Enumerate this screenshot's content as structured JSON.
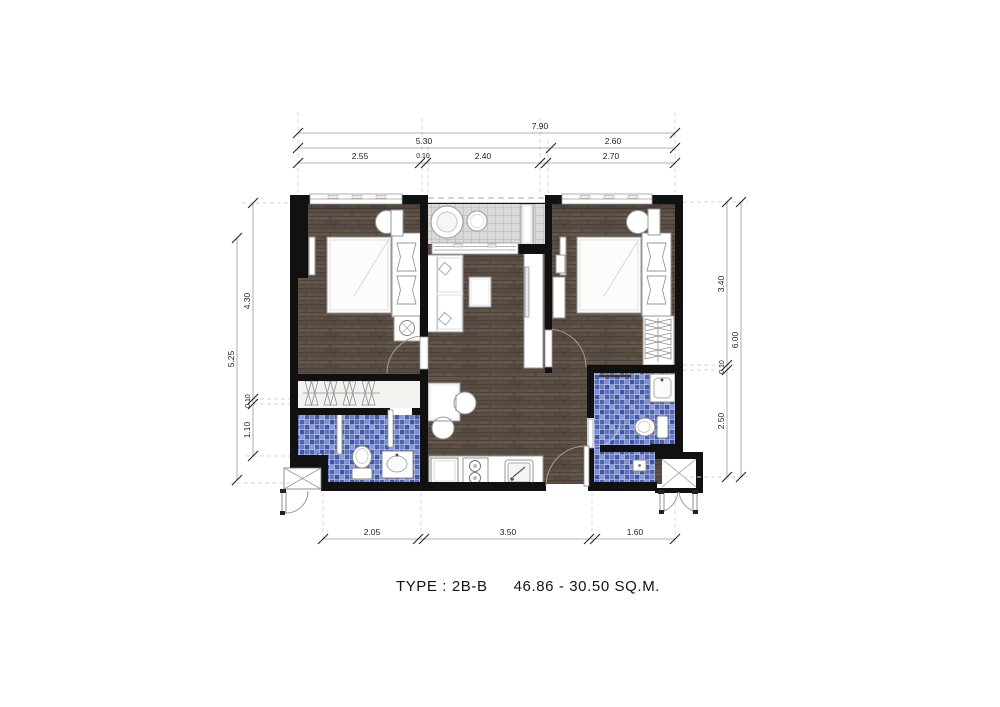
{
  "title": {
    "type": "TYPE : 2B-B",
    "area": "46.86 - 30.50 SQ.M."
  },
  "dims": {
    "top_total": "7.90",
    "top_mid": [
      "5.30",
      "2.60"
    ],
    "top_inner": [
      "2.55",
      "0.10",
      "2.40",
      "2.70"
    ],
    "left_outer": "5.25",
    "left_inner": [
      "4.30",
      "0.10",
      "1.10"
    ],
    "right_inner": [
      "3.40",
      "0.10",
      "2.50"
    ],
    "right_outer": "6.00",
    "bottom": [
      "2.05",
      "3.50",
      "1.60"
    ]
  },
  "colors": {
    "wall": "#111111",
    "wood_floor": "#5d5147",
    "bathroom_tile": "#51289f_mosaic_blues",
    "balcony_tile": "#d9dad8",
    "dimension_line": "#9a9a9a",
    "furniture_outline": "#979797"
  }
}
